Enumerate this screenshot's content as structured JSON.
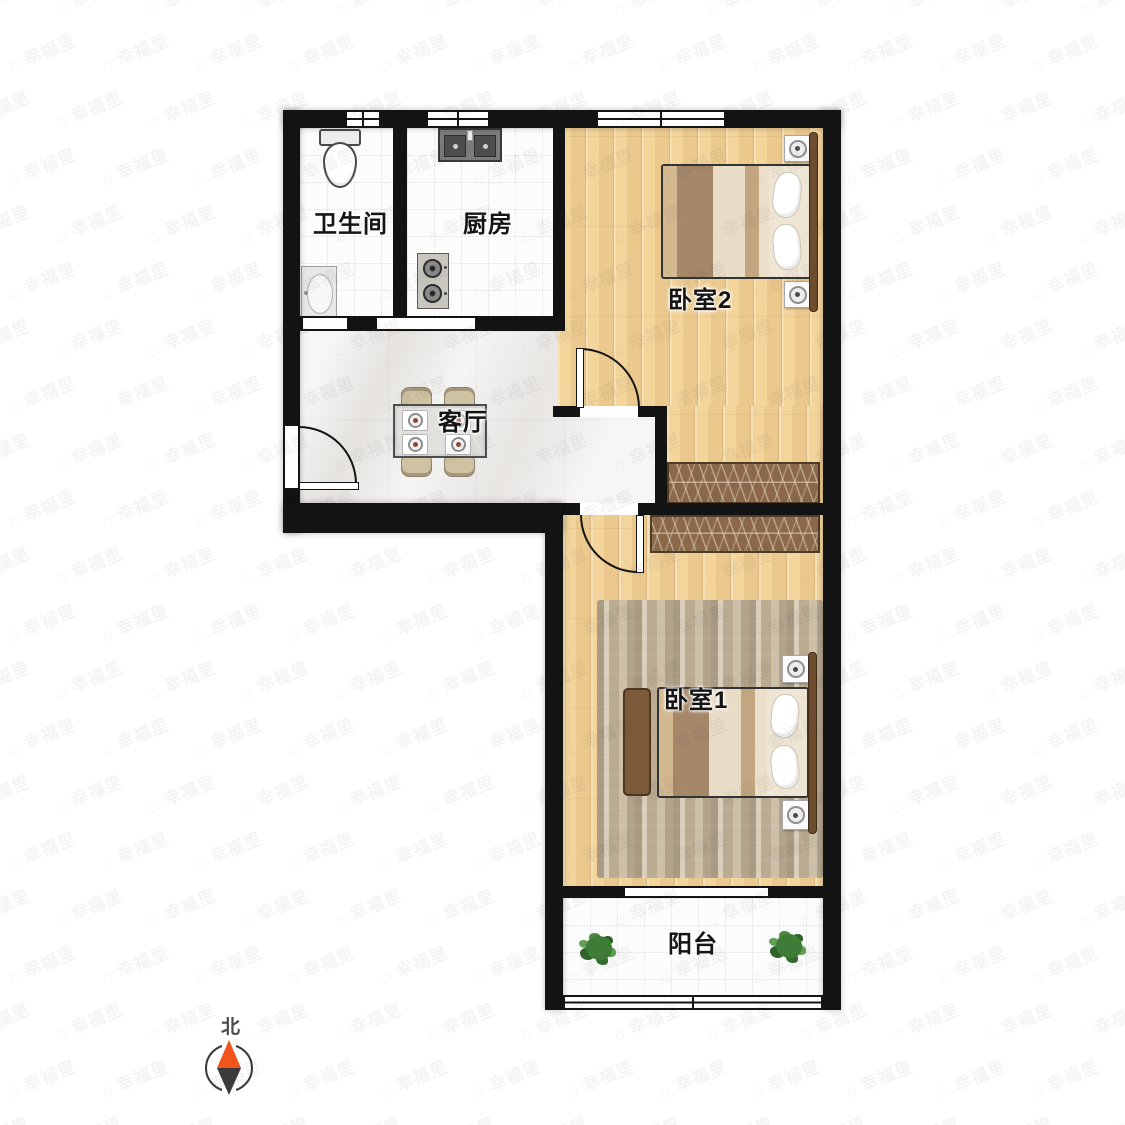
{
  "floorplan": {
    "rooms": {
      "bathroom": {
        "label": "卫生间"
      },
      "kitchen": {
        "label": "厨房"
      },
      "living_room": {
        "label": "客厅"
      },
      "bedroom2": {
        "label": "卧室2"
      },
      "bedroom1": {
        "label": "卧室1"
      },
      "balcony": {
        "label": "阳台"
      }
    },
    "compass": {
      "label": "北",
      "north_color": "#f2551c",
      "south_color": "#3b3b3d"
    },
    "watermark": {
      "text": "幸福里",
      "icon_glyph": "⌂"
    },
    "colors": {
      "wall": "#131313",
      "wood_floor": "#f3d49b",
      "marble_floor": "#eeecea",
      "tile_floor": "#fcfcfc",
      "wardrobe": "#8a6849",
      "rug": "#c9baa0",
      "plant_green": "#3f7c37",
      "bed_blanket_brown": "#a5876a"
    }
  }
}
